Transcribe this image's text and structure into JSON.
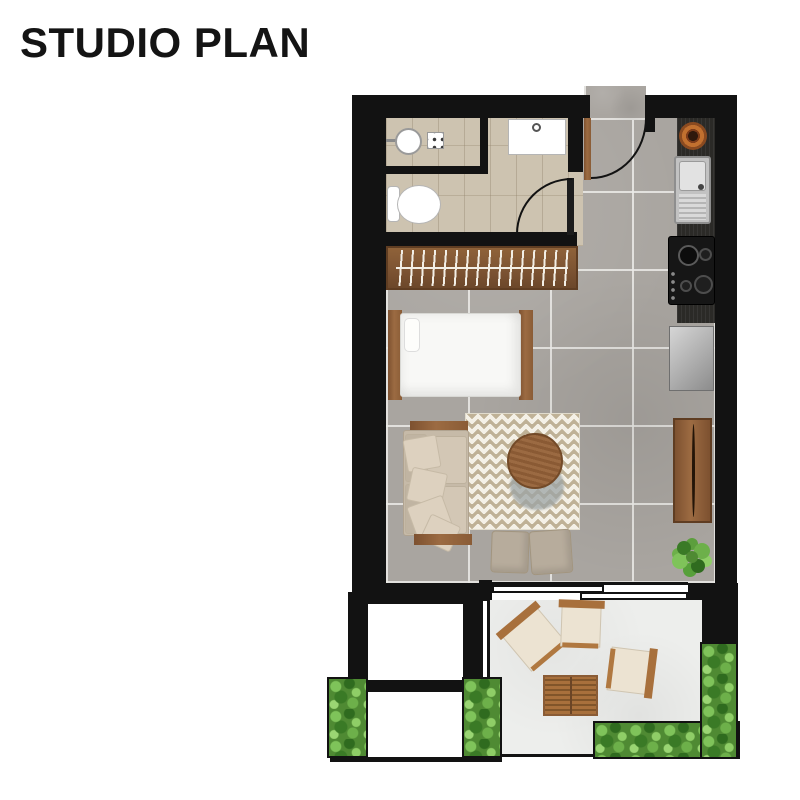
{
  "title": "STUDIO PLAN",
  "plan": {
    "rooms": [
      "bathroom",
      "entry",
      "kitchen",
      "sleeping-area",
      "living-area",
      "void",
      "terrace"
    ],
    "furniture_indoor": [
      "shower-basin",
      "shower-drain",
      "vanity-sink",
      "toilet",
      "wardrobe-with-hangers",
      "single-bed",
      "sofa",
      "chevron-rug",
      "round-coffee-table",
      "ottoman",
      "ottoman",
      "potted-plant"
    ],
    "kitchen_items": [
      "copper-bowl",
      "stainless-sink",
      "gas-stove-4-burners",
      "refrigerator",
      "folding-wall-table"
    ],
    "outdoor_items": [
      "lounge-chair",
      "lounge-chair",
      "lounge-chair",
      "slatted-wood-table",
      "planter-box",
      "planter-box",
      "planter-box",
      "planter-box"
    ],
    "doors": [
      "entry-swing-door",
      "bathroom-swing-door",
      "sliding-glass-door"
    ]
  },
  "colors": {
    "wall": "#121212",
    "floor": "#a9a5a0",
    "grout": "#ecebe8",
    "bathfloor": "#cdc3b0",
    "terrace": "#edeeec",
    "wood": "#8a5c36",
    "wooddark": "#5f3d22",
    "closetwood": "#7d5433",
    "counter": "#2b2a27",
    "copper": "#c1702f",
    "steel": "#c2c2c2",
    "stove": "#161616",
    "fridge1": "#d6d6d6",
    "fridge2": "#8c8c8c",
    "bedding": "#f8f8f6",
    "sofa": "#c6baa8",
    "cushion": "#d3c7b5",
    "rugbase": "#f4f0e6",
    "rugstripe": "#bfb196",
    "shadow": "#9da4a5",
    "ottoman": "#b7ac9c",
    "plantdark": "#2f6b1f",
    "plantmid": "#4f8a33",
    "plantlight": "#7fc35a",
    "ocushion": "#ece3d2",
    "owood": "#a8703c",
    "title": "#141414",
    "white": "#ffffff"
  }
}
